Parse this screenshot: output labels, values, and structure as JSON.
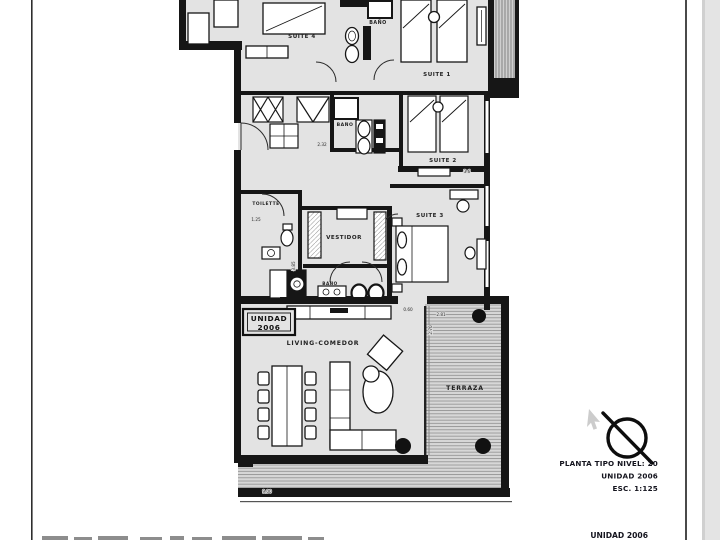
{
  "plan": {
    "unit_box": {
      "line1": "UNIDAD",
      "line2": "2006"
    },
    "rooms": {
      "suite4": "SUITE 4",
      "bano_top": "BAÑO",
      "suite1": "SUITE 1",
      "bano_mid": "BAÑO",
      "suite2": "SUITE 2",
      "toilette": "TOILETTE",
      "vestidor": "VESTIDOR",
      "suite3": "SUITE 3",
      "bano_low": "BAÑO",
      "living": "LIVING-COMEDOR",
      "terraza": "TERRAZA"
    },
    "dims": {
      "toilette_w": "1.25",
      "bano_mid_w": "2.32",
      "suite2_w": "3.6",
      "vestidor_h": "3.85",
      "terraza_gap": "0.60",
      "terraza_w": "2.81",
      "terraza_d": "2.70",
      "living_w": "9.00"
    },
    "colors": {
      "wall": "#161616",
      "floor": "#e3e3e3",
      "terrace_fill": "#d7d7d7",
      "paper": "#ffffff",
      "app_background": "#e4e4e4"
    },
    "icons": {
      "north_arrow": "circle-with-diagonal-line",
      "cursor": "pointer-arrow"
    }
  },
  "title_block": {
    "line1": "PLANTA TIPO NIVEL: 20",
    "line2": "UNIDAD 2006",
    "line3": "ESC.  1:125",
    "footer": "UNIDAD 2006"
  }
}
